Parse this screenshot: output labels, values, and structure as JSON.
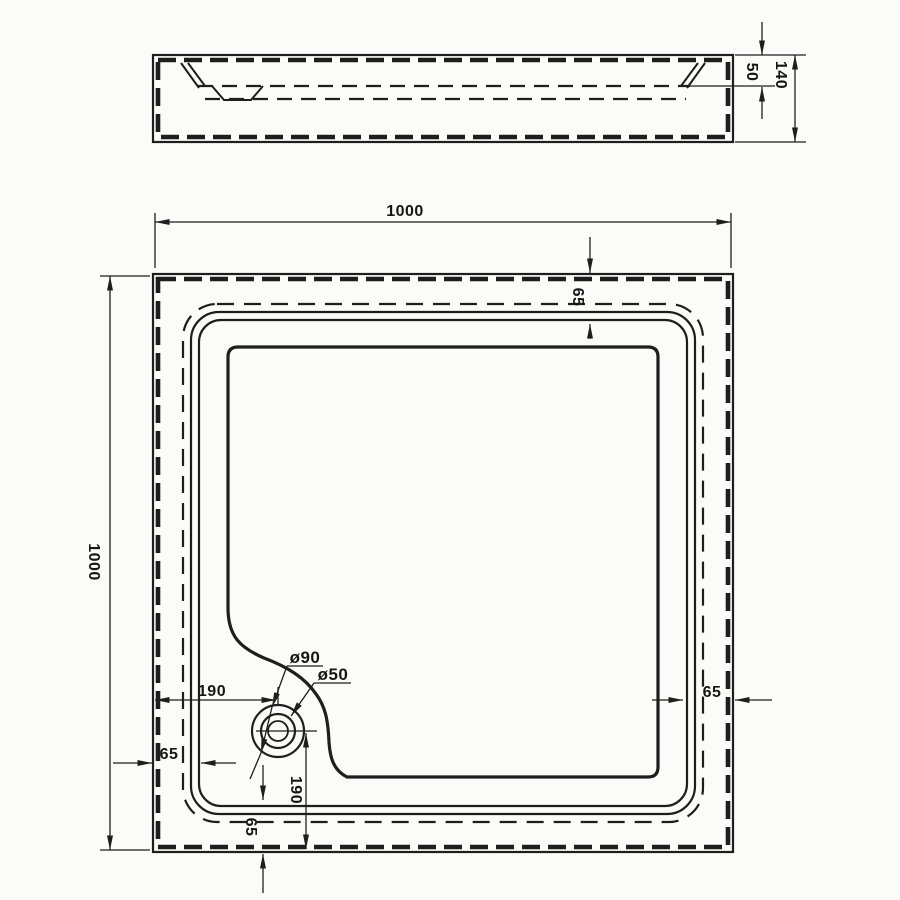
{
  "drawing": {
    "type": "technical-drawing",
    "subject": "square shower tray with corner drain",
    "colors": {
      "line": "#1e1e1e",
      "background": "#fbfbfa",
      "text": "#161616"
    },
    "side_view": {
      "dims": {
        "rim_depth": "50",
        "total_height": "140"
      }
    },
    "plan_view": {
      "dims": {
        "overall_width": "1000",
        "overall_height": "1000",
        "rim_top": "65",
        "rim_left": "65",
        "rim_right": "65",
        "rim_bottom": "65",
        "drain_offset_left": "190",
        "drain_offset_bottom": "190"
      },
      "drain": {
        "outer_diameter": "ø90",
        "inner_diameter": "ø50"
      }
    }
  }
}
